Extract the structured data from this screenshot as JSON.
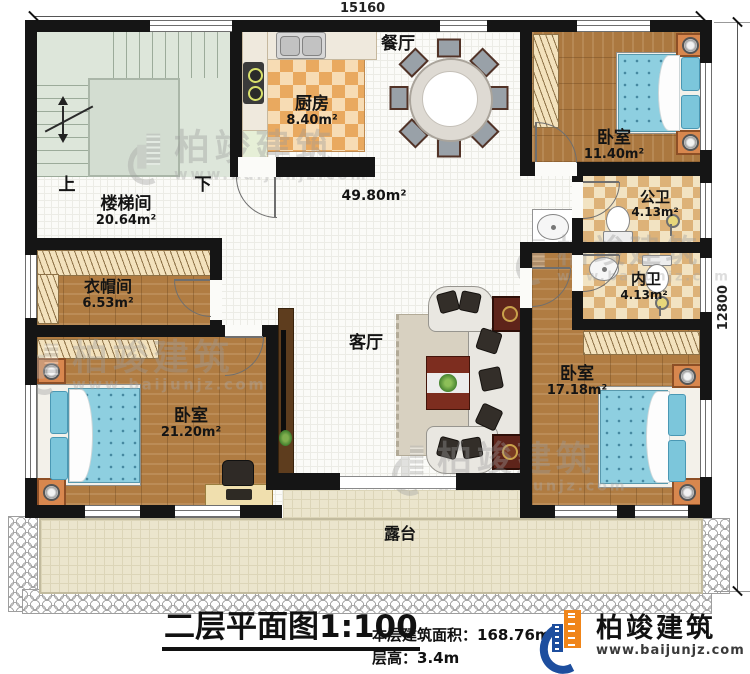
{
  "dimensions": {
    "width_mm": "15160",
    "depth_mm": "12800"
  },
  "rooms": {
    "stairwell": {
      "name": "楼梯间",
      "area": "20.64m²",
      "up": "上",
      "down": "下"
    },
    "kitchen": {
      "name": "厨房",
      "area": "8.40m²"
    },
    "dining": {
      "name": "餐厅"
    },
    "living": {
      "name": "客厅",
      "combined_area": "49.80m²"
    },
    "bedroom_top": {
      "name": "卧室",
      "area": "11.40m²"
    },
    "public_bath": {
      "name": "公卫",
      "area": "4.13m²"
    },
    "ensuite_bath": {
      "name": "内卫",
      "area": "4.13m²"
    },
    "bedroom_right": {
      "name": "卧室",
      "area": "17.18m²"
    },
    "cloakroom": {
      "name": "衣帽间",
      "area": "6.53m²"
    },
    "bedroom_left": {
      "name": "卧室",
      "area": "21.20m²"
    },
    "terrace": {
      "name": "露台"
    }
  },
  "title_block": {
    "title": "二层平面图",
    "scale": "1:100",
    "floor_area_label": "本层建筑面积：",
    "floor_area_value": "168.76m²",
    "floor_height_label": "层高：",
    "floor_height_value": "3.4m"
  },
  "brand": {
    "name": "柏竣建筑",
    "website": "www.baijunjz.com"
  },
  "watermark": {
    "name": "柏竣建筑",
    "website": "www.baijunjz.com"
  },
  "colors": {
    "wall": "#151515",
    "wood_floor": "#b07c42",
    "kitchen_checker": "#e9a95f",
    "bath_checker": "#ddb278",
    "bed_blue": "#8ecfe0",
    "terrace_tile": "#ebe5cd",
    "stair_green": "#dde6da",
    "brand_blue": "#1d4e9e",
    "brand_orange": "#f08519",
    "watermark_gray": "#9b9b9b"
  }
}
